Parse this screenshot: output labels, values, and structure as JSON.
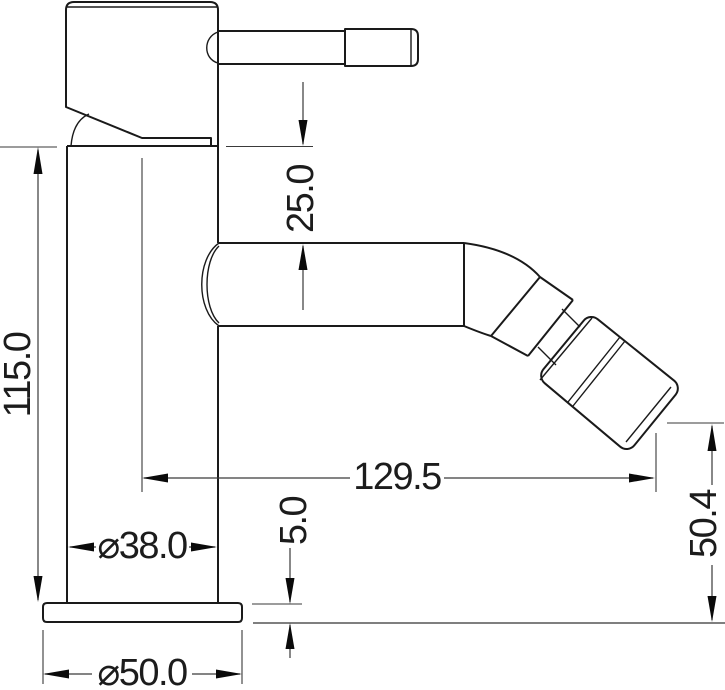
{
  "drawing": {
    "type": "technical-drawing",
    "subject": "single-lever-bidet-mixer-side-elevation",
    "labels": {
      "total_height": "115.0",
      "handle_to_spout": "25.0",
      "spout_reach": "129.5",
      "outlet_height": "50.4",
      "base_thickness": "5.0",
      "body_diameter": "⌀38.0",
      "base_diameter": "⌀50.0"
    },
    "colors": {
      "outline": "#1a1a1a",
      "dimension_line": "#3a3a3a",
      "arrow": "#0a0a0a",
      "background": "#ffffff"
    }
  }
}
